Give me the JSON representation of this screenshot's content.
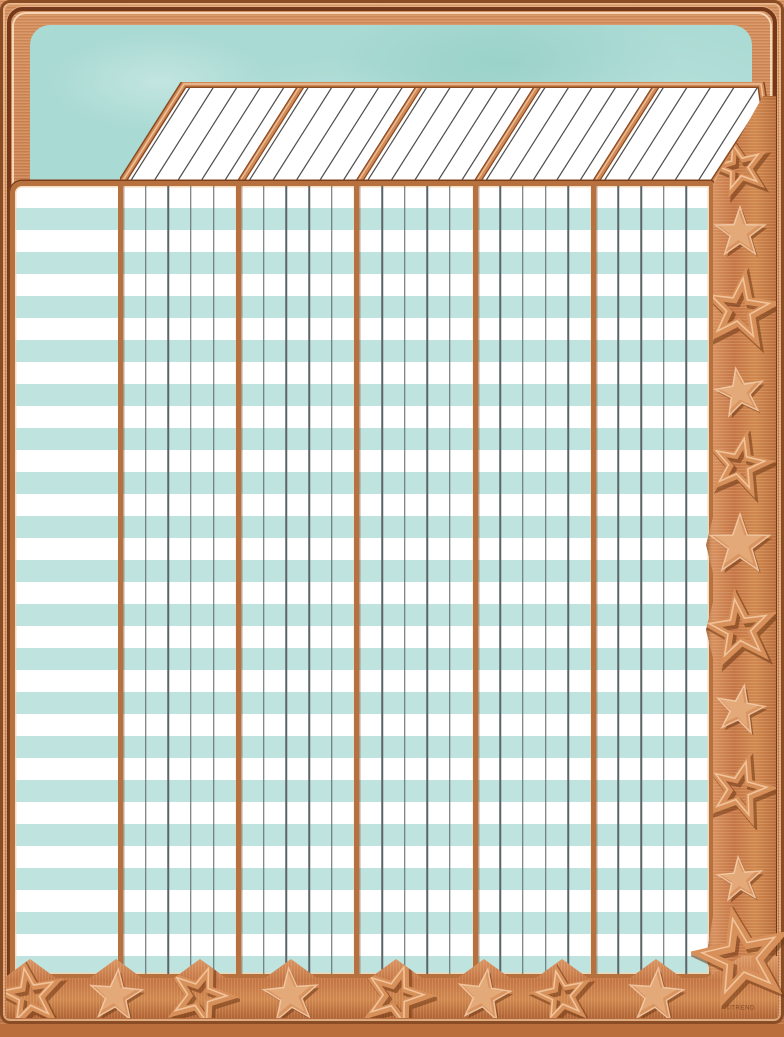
{
  "copyright": "©TREND",
  "palette": {
    "copper_light": "#eec19b",
    "copper_highlight": "#e8ab7d",
    "copper_mid": "#c87c4b",
    "copper_dark": "#8a4a22",
    "copper_deep": "#6b3315",
    "teal_panel": "#a9dad3",
    "teal_stripe": "#bfe3de",
    "paper_white": "#ffffff",
    "grid_line": "#5b6467",
    "header_rule_line": "#4f4f4f"
  },
  "header": {
    "columns": 5,
    "ruled_lines_per_column": 5,
    "style": "slanted-parallelogram"
  },
  "grid": {
    "name_column": true,
    "sections": 5,
    "subcolumns_per_section": 5,
    "rows": 36,
    "stripe_colors": [
      "#ffffff",
      "#bfe3de"
    ]
  },
  "right_band": {
    "stars": [
      {
        "type": "outline",
        "y": 168,
        "size": 46,
        "rot": -15
      },
      {
        "type": "filled",
        "y": 233,
        "size": 52,
        "rot": 0
      },
      {
        "type": "outline",
        "y": 310,
        "size": 62,
        "rot": 8
      },
      {
        "type": "filled",
        "y": 393,
        "size": 50,
        "rot": -10
      },
      {
        "type": "outline",
        "y": 465,
        "size": 52,
        "rot": 12
      },
      {
        "type": "filled",
        "y": 545,
        "size": 62,
        "rot": 0
      },
      {
        "type": "outline",
        "y": 630,
        "size": 60,
        "rot": -8
      },
      {
        "type": "filled",
        "y": 710,
        "size": 50,
        "rot": 10
      },
      {
        "type": "outline",
        "y": 790,
        "size": 56,
        "rot": 15
      },
      {
        "type": "filled",
        "y": 880,
        "size": 46,
        "rot": -5
      }
    ],
    "center_x": 740
  },
  "bottom_band": {
    "stars": [
      {
        "type": "outline",
        "x": 30,
        "size": 54,
        "rot": -10
      },
      {
        "type": "filled",
        "x": 116,
        "size": 54,
        "rot": 5
      },
      {
        "type": "outline",
        "x": 200,
        "size": 56,
        "rot": 20
      },
      {
        "type": "filled",
        "x": 291,
        "size": 56,
        "rot": -5
      },
      {
        "type": "outline",
        "x": 396,
        "size": 58,
        "rot": 18
      },
      {
        "type": "filled",
        "x": 484,
        "size": 54,
        "rot": 8
      },
      {
        "type": "outline",
        "x": 562,
        "size": 48,
        "rot": -12
      },
      {
        "type": "filled",
        "x": 656,
        "size": 56,
        "rot": 5
      }
    ],
    "center_y": 996
  },
  "corner_star": {
    "type": "outline",
    "x": 742,
    "y": 958,
    "size": 78,
    "rot": -12
  }
}
